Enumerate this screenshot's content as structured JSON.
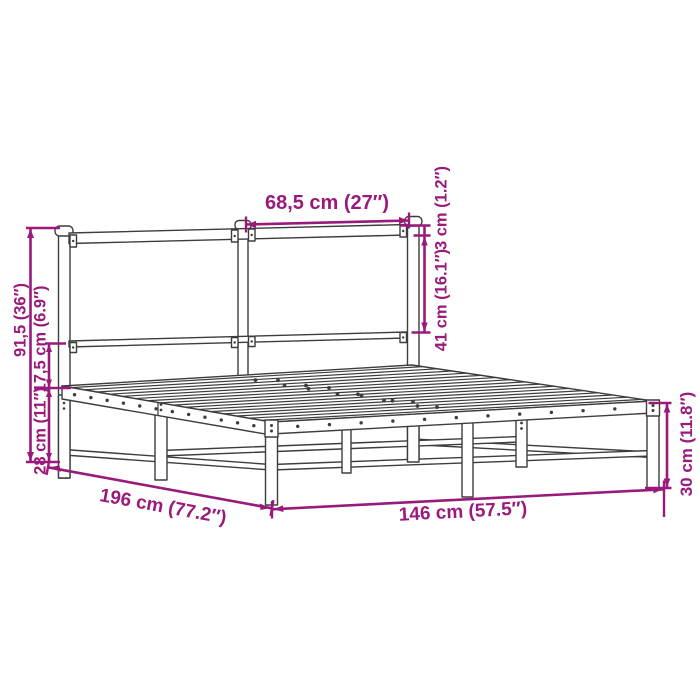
{
  "diagram": {
    "kind": "bed-frame-dimension-diagram",
    "colors": {
      "dimension": "#9A1A7B",
      "frame": "#3D3D3C",
      "background": "#FFFFFF"
    },
    "labels": {
      "headboard_panel_width": "68,5 cm (27″)",
      "headboard_rail_thickness": "3 cm (1.2″)",
      "headboard_rail_gap": "41 cm (16.1″)",
      "headboard_height": "91,5 (36″)",
      "rail_to_mid_rail": "17,5 cm (6.9″)",
      "under_bed_clearance": "28 cm (11″)",
      "frame_length": "196 cm (77.2″)",
      "frame_width": "146 cm (57.5″)",
      "foot_end_height": "30 cm (11.8″)"
    }
  }
}
